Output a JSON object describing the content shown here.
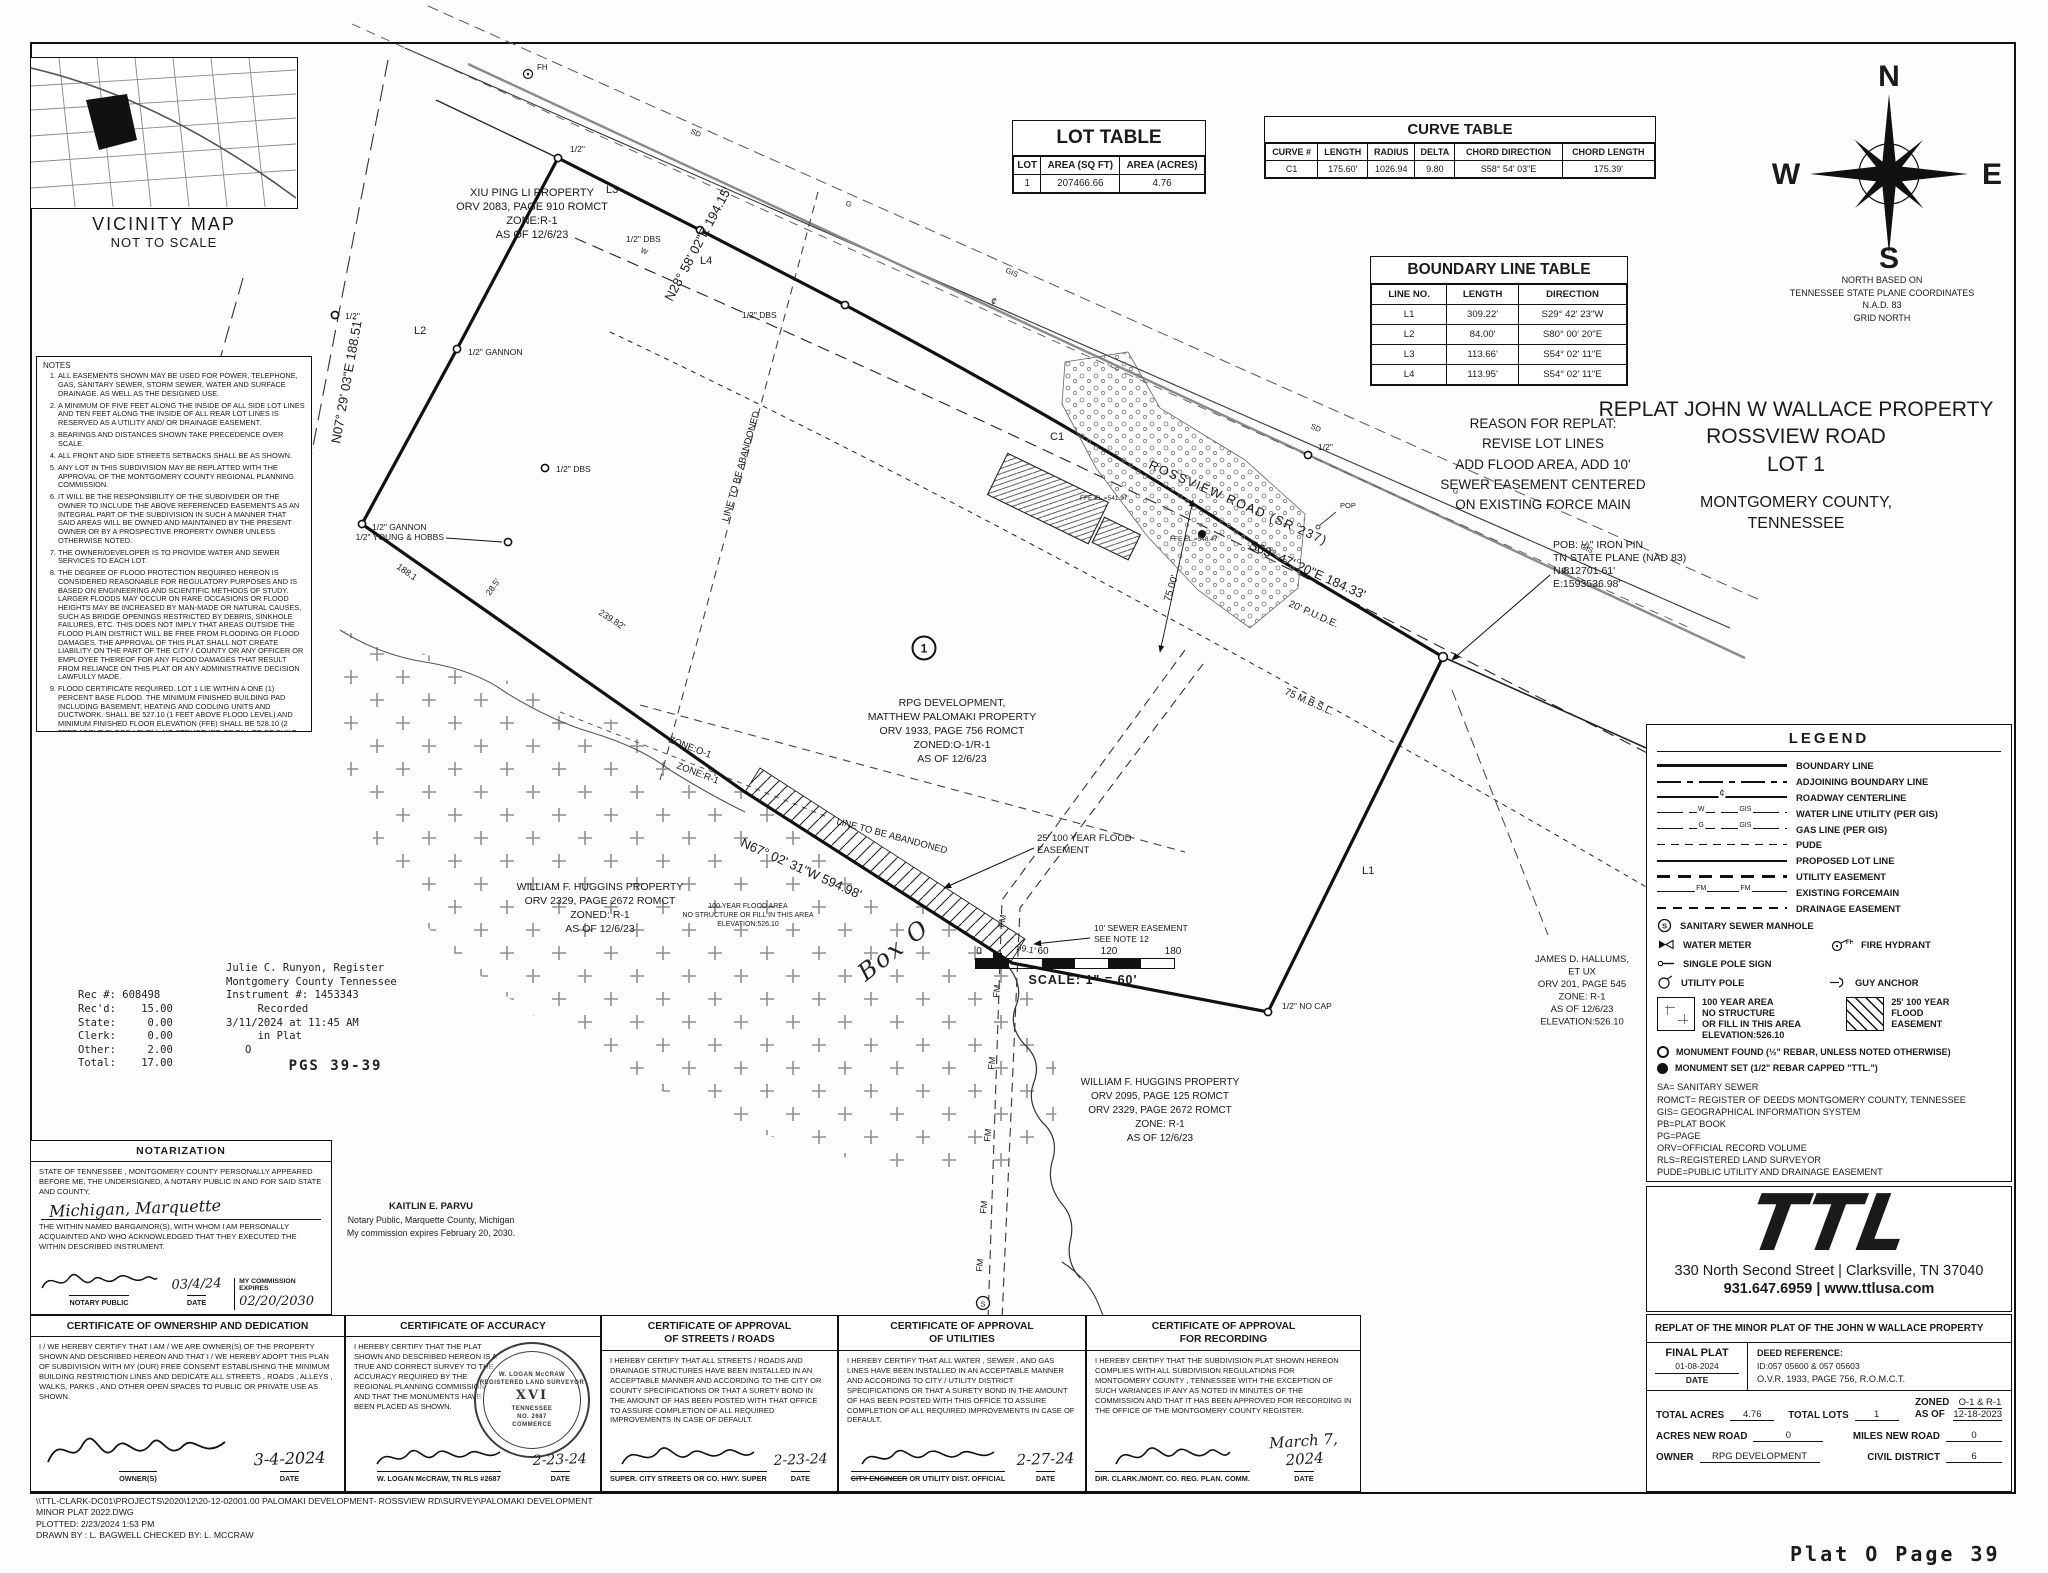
{
  "page_label": "Plat O Page 39",
  "vicinity": {
    "title": "VICINITY MAP",
    "subtitle": "NOT TO SCALE"
  },
  "notes": {
    "title": "NOTES",
    "items": [
      "ALL EASEMENTS SHOWN MAY BE USED FOR POWER, TELEPHONE, GAS, SANITARY SEWER, STORM SEWER, WATER AND SURFACE DRAINAGE. AS WELL AS THE DESIGNED USE.",
      "A MINIMUM OF FIVE FEET ALONG THE INSIDE OF ALL SIDE LOT LINES AND TEN FEET ALONG THE INSIDE OF ALL REAR LOT LINES IS RESERVED AS A UTILITY AND/ OR DRAINAGE EASEMENT.",
      "BEARINGS AND DISTANCES SHOWN TAKE PRECEDENCE OVER SCALE.",
      "ALL FRONT AND SIDE STREETS SETBACKS SHALL BE AS SHOWN.",
      "ANY LOT IN THIS SUBDIVISION MAY BE REPLATTED WITH THE APPROVAL OF THE MONTGOMERY COUNTY REGIONAL PLANNING COMMISSION.",
      "IT WILL BE THE RESPONSIBILITY OF THE SUBDIVIDER OR THE OWNER TO INCLUDE THE ABOVE REFERENCED EASEMENTS AS AN INTEGRAL PART OF THE SUBDIVISION IN SUCH A MANNER THAT SAID AREAS WILL BE OWNED AND MAINTAINED BY THE PRESENT OWNER OR BY A PROSPECTIVE PROPERTY OWNER UNLESS OTHERWISE NOTED.",
      "THE OWNER/DEVELOPER IS TO PROVIDE WATER AND SEWER SERVICES TO EACH LOT.",
      "THE DEGREE OF FLOOD PROTECTION REQUIRED HEREON IS CONSIDERED REASONABLE FOR REGULATORY PURPOSES AND IS BASED ON ENGINEERING AND SCIENTIFIC METHODS OF STUDY. LARGER FLOODS MAY OCCUR ON RARE OCCASIONS OR FLOOD HEIGHTS MAY BE INCREASED BY MAN-MADE OR NATURAL CAUSES, SUCH AS BRIDGE OPENINGS RESTRICTED BY DEBRIS, SINKHOLE FAILURES, ETC. THIS DOES NOT IMPLY THAT AREAS OUTSIDE THE FLOOD PLAIN DISTRICT WILL BE FREE FROM FLOODING OR FLOOD DAMAGES. THE APPROVAL OF THIS PLAT SHALL NOT CREATE LIABILITY ON THE PART OF THE CITY / COUNTY OR ANY OFFICER OR EMPLOYEE THEREOF FOR ANY FLOOD DAMAGES THAT RESULT FROM RELIANCE ON THIS PLAT OR ANY ADMINISTRATIVE DECISION LAWFULLY MADE.",
      "FLOOD CERTIFICATE REQUIRED. LOT 1 LIE WITHIN A ONE (1) PERCENT BASE FLOOD. THE MINIMUM FINISHED BUILDING PAD INCLUDING BASEMENT, HEATING AND COOLING UNITS AND DUCTWORK. SHALL BE 527.10 (1 FEET ABOVE FLOOD LEVEL) AND MINIMUM FINISHED FLOOR ELEVATION (FFE) SHALL BE 528.10 (2 FEET ABOVE FLOOD LEVEL). NO STRUCTURE OR FILL TO BE BUILT IN THIS AREA.",
      "THIS PLAT DOES NOT REQUIRE DEDICATION OF ANY LAND TO THE PUBLIC OR INSTALLATION OF ANY PUBLIC IMPROVEMENTS.",
      "THE OWNER MUST OBTAIN A DRIVEWAY CONNECTION PERMIT FROM TDOT BEFORE CONSTRUCTION BEGINS ON SITE.",
      "10' EASEMENT CENTERED ON EXISTING FORCE MAIN.",
      "AN EXISTING STRUCTURE IS LOCATED WITHIN THE MINIMUM BUILDING SETBACK LINE AND PUBLIC UTILITY AND DRAINAGE EASEMENT FOR LOT 1. IF THE EXISTING STRUCTURE CANNOT BE ENLARGED OR ALTERED IN SUCH A WAY THAT WOULD INCREASE ENCROACHMENT INTO THE SETBACK OR EASEMENT AREA. IF THE STRUCTURE IS REMOVED OR DESTROYED ANY NEW STRUCTURES MUST COMPLY WITH ALL CURRENT SETBACK AND EASEMENT REQUIREMENTS."
    ]
  },
  "stamp": {
    "pairs": [
      [
        "",
        "Julie C. Runyon, Register"
      ],
      [
        "",
        "Montgomery County Tennessee"
      ],
      [
        "Rec #: 608498",
        "Instrument #: 1453343"
      ],
      [
        "Rec'd:    15.00",
        "     Recorded"
      ],
      [
        "State:     0.00",
        "3/11/2024 at 11:45 AM"
      ],
      [
        "Clerk:     0.00",
        "     in Plat"
      ],
      [
        "Other:     2.00",
        "   O"
      ],
      [
        "Total:    17.00",
        "      PGS 39-39"
      ]
    ]
  },
  "lot_table": {
    "title": "LOT TABLE",
    "headers": [
      "LOT",
      "AREA (SQ FT)",
      "AREA (ACRES)"
    ],
    "rows": [
      [
        "1",
        "207466.66",
        "4.76"
      ]
    ]
  },
  "curve_table": {
    "title": "CURVE TABLE",
    "headers": [
      "CURVE #",
      "LENGTH",
      "RADIUS",
      "DELTA",
      "CHORD DIRECTION",
      "CHORD LENGTH"
    ],
    "rows": [
      [
        "C1",
        "175.60'",
        "1026.94",
        "9.80",
        "S58° 54' 03\"E",
        "175.39'"
      ]
    ]
  },
  "boundary_table": {
    "title": "BOUNDARY LINE TABLE",
    "headers": [
      "LINE NO.",
      "LENGTH",
      "DIRECTION"
    ],
    "rows": [
      [
        "L1",
        "309.22'",
        "S29° 42' 23\"W"
      ],
      [
        "L2",
        "84.00'",
        "S80° 00' 20\"E"
      ],
      [
        "L3",
        "113.66'",
        "S54° 02' 11\"E"
      ],
      [
        "L4",
        "113.95'",
        "S54° 02' 11\"E"
      ]
    ]
  },
  "compass": {
    "n": "N",
    "w": "W",
    "e": "E",
    "s": "S",
    "caption": [
      "NORTH BASED ON",
      "TENNESSEE STATE PLANE COORDINATES",
      "N.A.D. 83",
      "GRID NORTH"
    ]
  },
  "titles": {
    "reason": [
      "REASON FOR REPLAT:",
      "REVISE LOT LINES",
      "ADD FLOOD AREA, ADD 10'",
      "SEWER EASEMENT CENTERED",
      "ON EXISTING FORCE MAIN"
    ],
    "main": [
      "REPLAT JOHN W WALLACE PROPERTY",
      "ROSSVIEW ROAD",
      "LOT 1"
    ],
    "county": [
      "MONTGOMERY COUNTY,",
      "TENNESSEE"
    ]
  },
  "legend": {
    "title": "LEGEND",
    "line_items": [
      {
        "style": "boundary",
        "label": "BOUNDARY LINE"
      },
      {
        "style": "adjoining",
        "label": "ADJOINING BOUNDARY LINE"
      },
      {
        "style": "centerline",
        "label": "ROADWAY CENTERLINE",
        "marks": [
          "¢"
        ]
      },
      {
        "style": "water",
        "label": "WATER LINE UTILITY (PER GIS)",
        "marks": [
          "W",
          "GIS"
        ]
      },
      {
        "style": "gas",
        "label": "GAS LINE (PER GIS)",
        "marks": [
          "G",
          "GIS"
        ]
      },
      {
        "style": "pude",
        "label": "PUDE"
      },
      {
        "style": "lotline",
        "label": "PROPOSED LOT LINE"
      },
      {
        "style": "utility",
        "label": "UTILITY EASEMENT"
      },
      {
        "style": "forcemain",
        "label": "EXISTING FORCEMAIN",
        "marks": [
          "FM",
          "FM"
        ]
      },
      {
        "style": "drainage",
        "label": "DRAINAGE EASEMENT"
      }
    ],
    "sym_manhole": "SANITARY SEWER MANHOLE",
    "sym_water_meter": "WATER METER",
    "sym_fire_hydrant": "FIRE HYDRANT",
    "sym_fh_tag": "FH",
    "sym_pole_sign": "SINGLE POLE SIGN",
    "sym_utility_pole": "UTILITY POLE",
    "sym_guy_anchor": "GUY ANCHOR",
    "area_100yr": [
      "100 YEAR AREA",
      "NO STRUCTURE",
      "OR FILL IN THIS AREA",
      "ELEVATION:526.10"
    ],
    "area_flood": [
      "25' 100 YEAR",
      "FLOOD",
      "EASEMENT"
    ],
    "mon_found": "MONUMENT FOUND (½\" REBAR, UNLESS NOTED OTHERWISE)",
    "mon_set": "MONUMENT SET (1/2\" REBAR CAPPED \"TTL.\")",
    "abbreviations": [
      "SA= SANITARY SEWER",
      "ROMCT= REGISTER OF DEEDS MONTGOMERY COUNTY, TENNESSEE",
      "GIS= GEOGRAPHICAL INFORMATION SYSTEM",
      "PB=PLAT BOOK",
      "PG=PAGE",
      "ORV=OFFICIAL RECORD VOLUME",
      "RLS=REGISTERED LAND SURVEYOR",
      "PUDE=PUBLIC UTILITY AND DRAINAGE EASEMENT"
    ]
  },
  "ttl": {
    "logo": "TTL",
    "address": "330 North Second Street  |  Clarksville, TN 37040",
    "phone": "931.647.6959  |  www.ttlusa.com"
  },
  "sheet": {
    "project": "REPLAT OF THE MINOR PLAT OF THE JOHN W WALLACE PROPERTY",
    "final_plat": "FINAL PLAT",
    "final_date": "01-08-2024",
    "date_label": "DATE",
    "deed_label": "DEED REFERENCE:",
    "deed_id": "ID:057 05600 & 057 05603",
    "deed_ovr": "O.V.R. 1933, PAGE 756, R.O.M.C.T.",
    "total_acres_label": "TOTAL ACRES",
    "total_acres": "4.76",
    "total_lots_label": "TOTAL LOTS",
    "total_lots": "1",
    "zoned_label": "ZONED",
    "zoned": "O-1 & R-1",
    "asof_label": "AS OF",
    "asof": "12-18-2023",
    "anr_label": "ACRES NEW ROAD",
    "anr": "0",
    "mnr_label": "MILES NEW ROAD",
    "mnr": "0",
    "owner_label": "OWNER",
    "owner": "RPG DEVELOPMENT",
    "cd_label": "CIVIL DISTRICT",
    "cd": "6"
  },
  "notarization": {
    "title": "NOTARIZATION",
    "body1": "STATE OF TENNESSEE , MONTGOMERY COUNTY PERSONALLY APPEARED BEFORE ME, THE UNDERSIGNED, A NOTARY PUBLIC IN AND FOR SAID STATE AND COUNTY,",
    "name_hand": "Michigan, Marquette",
    "body2": "THE WITHIN NAMED BARGAINOR(S), WITH WHOM I AM PERSONALLY ACQUAINTED AND WHO ACKNOWLEDGED THAT THEY EXECUTED THE WITHIN DESCRIBED INSTRUMENT.",
    "sig_label": "NOTARY PUBLIC",
    "date_label": "DATE",
    "date": "03/4/24",
    "comm_label": "MY COMMISSION EXPIRES",
    "comm_value": "02/20/2030"
  },
  "notary_stamp": {
    "name": "KAITLIN E. PARVU",
    "line2": "Notary Public, Marquette County, Michigan",
    "line3": "My commission expires February 20, 2030."
  },
  "certificates": {
    "ownership": {
      "title": "CERTIFICATE OF OWNERSHIP AND DEDICATION",
      "body": "I / WE HEREBY CERTIFY THAT I AM / WE ARE OWNER(S) OF THE PROPERTY SHOWN AND DESCRIBED HEREON AND THAT I / WE HEREBY ADOPT THIS PLAN OF SUBDIVISION WITH MY (OUR) FREE CONSENT ESTABLISHING THE MINIMUM BUILDING RESTRICTION LINES AND DEDICATE ALL STREETS , ROADS , ALLEYS , WALKS, PARKS , AND  OTHER OPEN SPACES TO PUBLIC OR PRIVATE USE AS SHOWN.",
      "sig_label": "OWNER(S)",
      "date_label": "DATE",
      "date": "3-4-2024"
    },
    "accuracy": {
      "title": "CERTIFICATE OF ACCURACY",
      "body": "I HEREBY CERTIFY THAT THE PLAT SHOWN AND DESCRIBED HEREON IS A TRUE AND CORRECT SURVEY TO THE ACCURACY REQUIRED BY THE REGIONAL PLANNING COMMISSION AND THAT THE MONUMENTS HAVE BEEN PLACED AS SHOWN.",
      "sig_label": "W. LOGAN McCRAW, TN RLS #2687",
      "date": "2-23-24",
      "seal": [
        "W. LOGAN McCRAW",
        "REGISTERED LAND SURVEYOR",
        "XVI",
        "TENNESSEE",
        "NO. 2687",
        "COMMERCE"
      ]
    },
    "streets": {
      "title1": "CERTIFICATE OF APPROVAL",
      "title2": "OF STREETS / ROADS",
      "body": "I HEREBY CERTIFY THAT ALL STREETS / ROADS AND DRAINAGE STRUCTURES HAVE BEEN INSTALLED IN AN ACCEPTABLE MANNER AND ACCORDING TO THE CITY OR COUNTY SPECIFICATIONS OR THAT A SURETY BOND IN THE AMOUNT OF              HAS BEEN POSTED WITH THAT OFFICE TO ASSURE COMPLETION OF ALL REQUIRED IMPROVEMENTS IN CASE OF DEFAULT.",
      "sig_label": "SUPER. CITY STREETS OR CO. HWY. SUPER",
      "date_label": "DATE",
      "date": "2-23-24"
    },
    "utilities": {
      "title1": "CERTIFICATE OF APPROVAL",
      "title2": "OF UTILITIES",
      "body": "I HEREBY CERTIFY THAT ALL WATER , SEWER , AND GAS LINES HAVE BEEN INSTALLED IN AN ACCEPTABLE MANNER AND ACCORDING TO CITY / UTILITY DISTRICT SPECIFICATIONS OR THAT A SURETY BOND IN THE AMOUNT OF              HAS BEEN POSTED WITH THIS OFFICE TO ASSURE COMPLETION OF ALL REQUIRED IMPROVEMENTS IN CASE OF DEFAULT.",
      "sig_struck": "CITY ENGINEER",
      "sig_rest": " OR UTILITY DIST. OFFICIAL",
      "date_label": "DATE",
      "date": "2-27-24"
    },
    "recording": {
      "title1": "CERTIFICATE OF APPROVAL",
      "title2": "FOR RECORDING",
      "body": "I HEREBY CERTIFY THAT THE SUBDIVISION PLAT SHOWN HEREON COMPLIES WITH ALL SUBDIVISION REGULATIONS FOR MONTGOMERY COUNTY , TENNESSEE WITH THE EXCEPTION OF SUCH VARIANCES IF ANY AS NOTED IN MINUTES OF THE COMMISSION AND THAT IT HAS BEEN APPROVED FOR RECORDING IN THE OFFICE OF THE MONTGOMERY COUNTY REGISTER.",
      "sig_label": "DIR. CLARK./MONT. CO. REG. PLAN. COMM.",
      "date_label": "DATE",
      "date": "March 7, 2024"
    }
  },
  "footer": {
    "lines": [
      "\\\\TTL-CLARK-DC01\\PROJECTS\\2020\\12\\20-12-02001.00 PALOMAKI DEVELOPMENT- ROSSVIEW RD\\SURVEY\\PALOMAKI DEVELOPMENT",
      "MINOR PLAT 2022.DWG",
      "PLOTTED: 2/23/2024 1:53 PM",
      "DRAWN BY : L. BAGWELL  CHECKED BY: L. MCCRAW"
    ]
  },
  "scale": {
    "ticks": [
      "0",
      "60",
      "120",
      "180"
    ],
    "caption": "SCALE: 1\" = 60'"
  },
  "plat": {
    "road_name": "ROSSVIEW ROAD (SR 237)",
    "brg_road": "S63° 47' 20\"E  184.33'",
    "brg_ne": "N28° 58' 02\"E  194.15'",
    "brg_w": "N07° 29' 03\"E  188.51'",
    "brg_s": "N67° 02' 31\"W  594.98'",
    "pude": "20' P.U.D.E.",
    "mbsl": "75 M.B.S.L.",
    "dim75": "75.00'",
    "dim59": "59.1'",
    "dim188": "188.1",
    "dim239": "239.82'",
    "dim28": "28.5'",
    "l1": "L1",
    "l2": "L2",
    "l3": "L3",
    "l4": "L4",
    "c1": "C1",
    "lot1": "1",
    "fh": "FH",
    "fm": "FM",
    "pop": "POP",
    "pob": [
      "POB: ½\" IRON PIN",
      "TN STATE PLANE (NAD 83)",
      "N:812701.61'",
      "E:1593536.98'"
    ],
    "rpg": [
      "RPG DEVELOPMENT,",
      "MATTHEW PALOMAKI PROPERTY",
      "ORV 1933, PAGE 756 ROMCT",
      "ZONED:O-1/R-1",
      "AS OF 12/6/23"
    ],
    "xiu": [
      "XIU PING LI PROPERTY",
      "ORV 2083, PAGE 910 ROMCT",
      "ZONE:R-1",
      "AS OF 12/6/23"
    ],
    "huggins_w": [
      "WILLIAM F. HUGGINS  PROPERTY",
      "ORV 2329, PAGE 2672 ROMCT",
      "ZONED: R-1",
      "AS OF 12/6/23"
    ],
    "huggins_s": [
      "WILLIAM F. HUGGINS  PROPERTY",
      "ORV 2095, PAGE 125 ROMCT",
      "ORV 2329, PAGE 2672 ROMCT",
      "ZONE: R-1",
      "AS OF 12/6/23"
    ],
    "hallums": [
      "JAMES D. HALLUMS,",
      "ET UX",
      "ORV 201, PAGE 545",
      "ZONE: R-1",
      "AS OF 12/6/23",
      "ELEVATION:526.10"
    ],
    "flood_note": [
      "100 YEAR FLOOD AREA",
      "NO STRUCTURE OR FILL IN THIS AREA",
      "ELEVATION:526.10"
    ],
    "flood_esmt": [
      "25' 100 YEAR FLOOD",
      "EASEMENT"
    ],
    "sewer_esmt": [
      "10' SEWER EASEMENT",
      "SEE NOTE 12"
    ],
    "abandoned": "LINE TO BE ABANDONED",
    "zone_o1": "ZONE:O-1",
    "zone_r1": "ZONE:R-1",
    "m_half": "1/2\"",
    "m_gannon": "1/2\" GANNON",
    "m_dbs": "1/2\" DBS",
    "m_yh": "1/2\" YOUNG & HOBBS",
    "m_nocap": "1/2\" NO CAP",
    "ffe1": "FFE EL.=541.97'",
    "ffe2": "FFE EL.=548.47'",
    "box_o": "Box O"
  }
}
